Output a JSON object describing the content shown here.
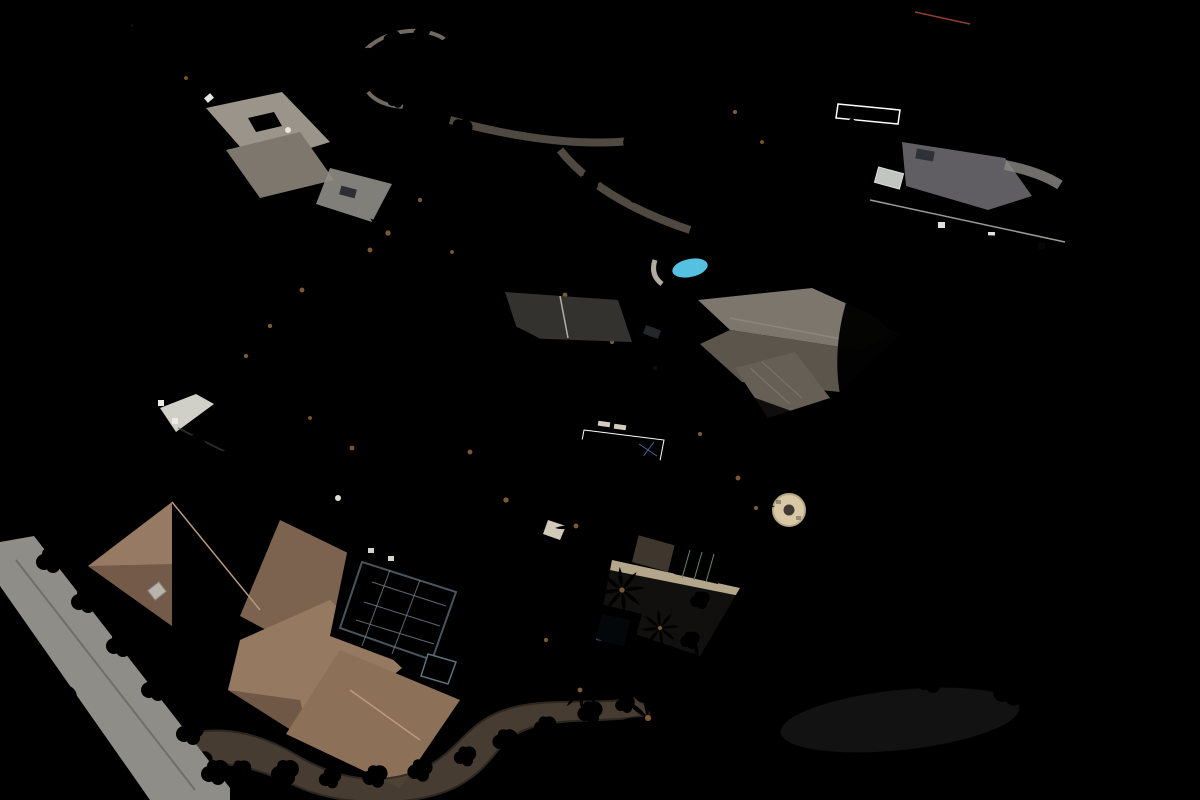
{
  "canvas": {
    "width": 1200,
    "height": 800
  },
  "scene_description": "Oblique aerial drone photo of tropical residential lots; a red outline marks the boundary of the center parcel containing a tan-roof house, pool and large lawn.",
  "boundary": {
    "points": "380,263 1000,486 842,772 168,434",
    "color": "#f21511",
    "stroke_width": 4
  },
  "palette": {
    "bg_veg": "#5d8238",
    "forest_dark": "#2f5520",
    "forest_mid": "#4e7a2c",
    "forest_light": "#72a13e",
    "shrub_yellow": "#b9cc52",
    "shrub_gold": "#d2c44a",
    "flower_pink": "#c08fbe",
    "flower_red": "#c23b2a",
    "flower_orange": "#d0872f",
    "lawn_bright": "#a6c061",
    "lawn_mid": "#8cab4f",
    "lawn_putting": "#53a332",
    "grass_pale": "#b5bc71",
    "soil_lava": "#463c31",
    "soil_dirt": "#8a7158",
    "soil_pale": "#9f8566",
    "road_asphalt": "#504e54",
    "road_worn": "#6e6c72",
    "road_line_white": "#e9e9e4",
    "road_line_yellow": "#d2a93d",
    "lane_concrete": "#c4c3bc",
    "drive_dark": "#4c4846",
    "stone_wall": "#3f382e",
    "palm_green": "#3c7427",
    "palm_light": "#579336",
    "cypress": "#1f3d14",
    "roof_tan": "#c9b99d",
    "roof_tan_shade": "#a5977e",
    "roof_ridge": "#e7ddc3",
    "roof_brown": "#94785f",
    "roof_brown_shade": "#6f5846",
    "roof_brown_stripe": "#a8886c",
    "roof_gray": "#abaaa5",
    "roof_gray_shade": "#82807a",
    "roof_gray_dark": "#6e6c66",
    "roof_terra": "#b4523b",
    "wall_white": "#e5e2da",
    "solar_panel": "#2b313b",
    "pool_blue": "#49c0e6",
    "pool_deep": "#2f9cc8",
    "pool_pale": "#8fd9ea",
    "pool_cover": "#5c6974",
    "spa_blue": "#7791a2",
    "umbrella_navy": "#2c4a6e",
    "deck_tan": "#dbd0ad",
    "deck_stone": "#cdbb97",
    "green_roof": "#3f6b4a",
    "car_red": "#c03428",
    "car_navy": "#1e3a5e"
  }
}
